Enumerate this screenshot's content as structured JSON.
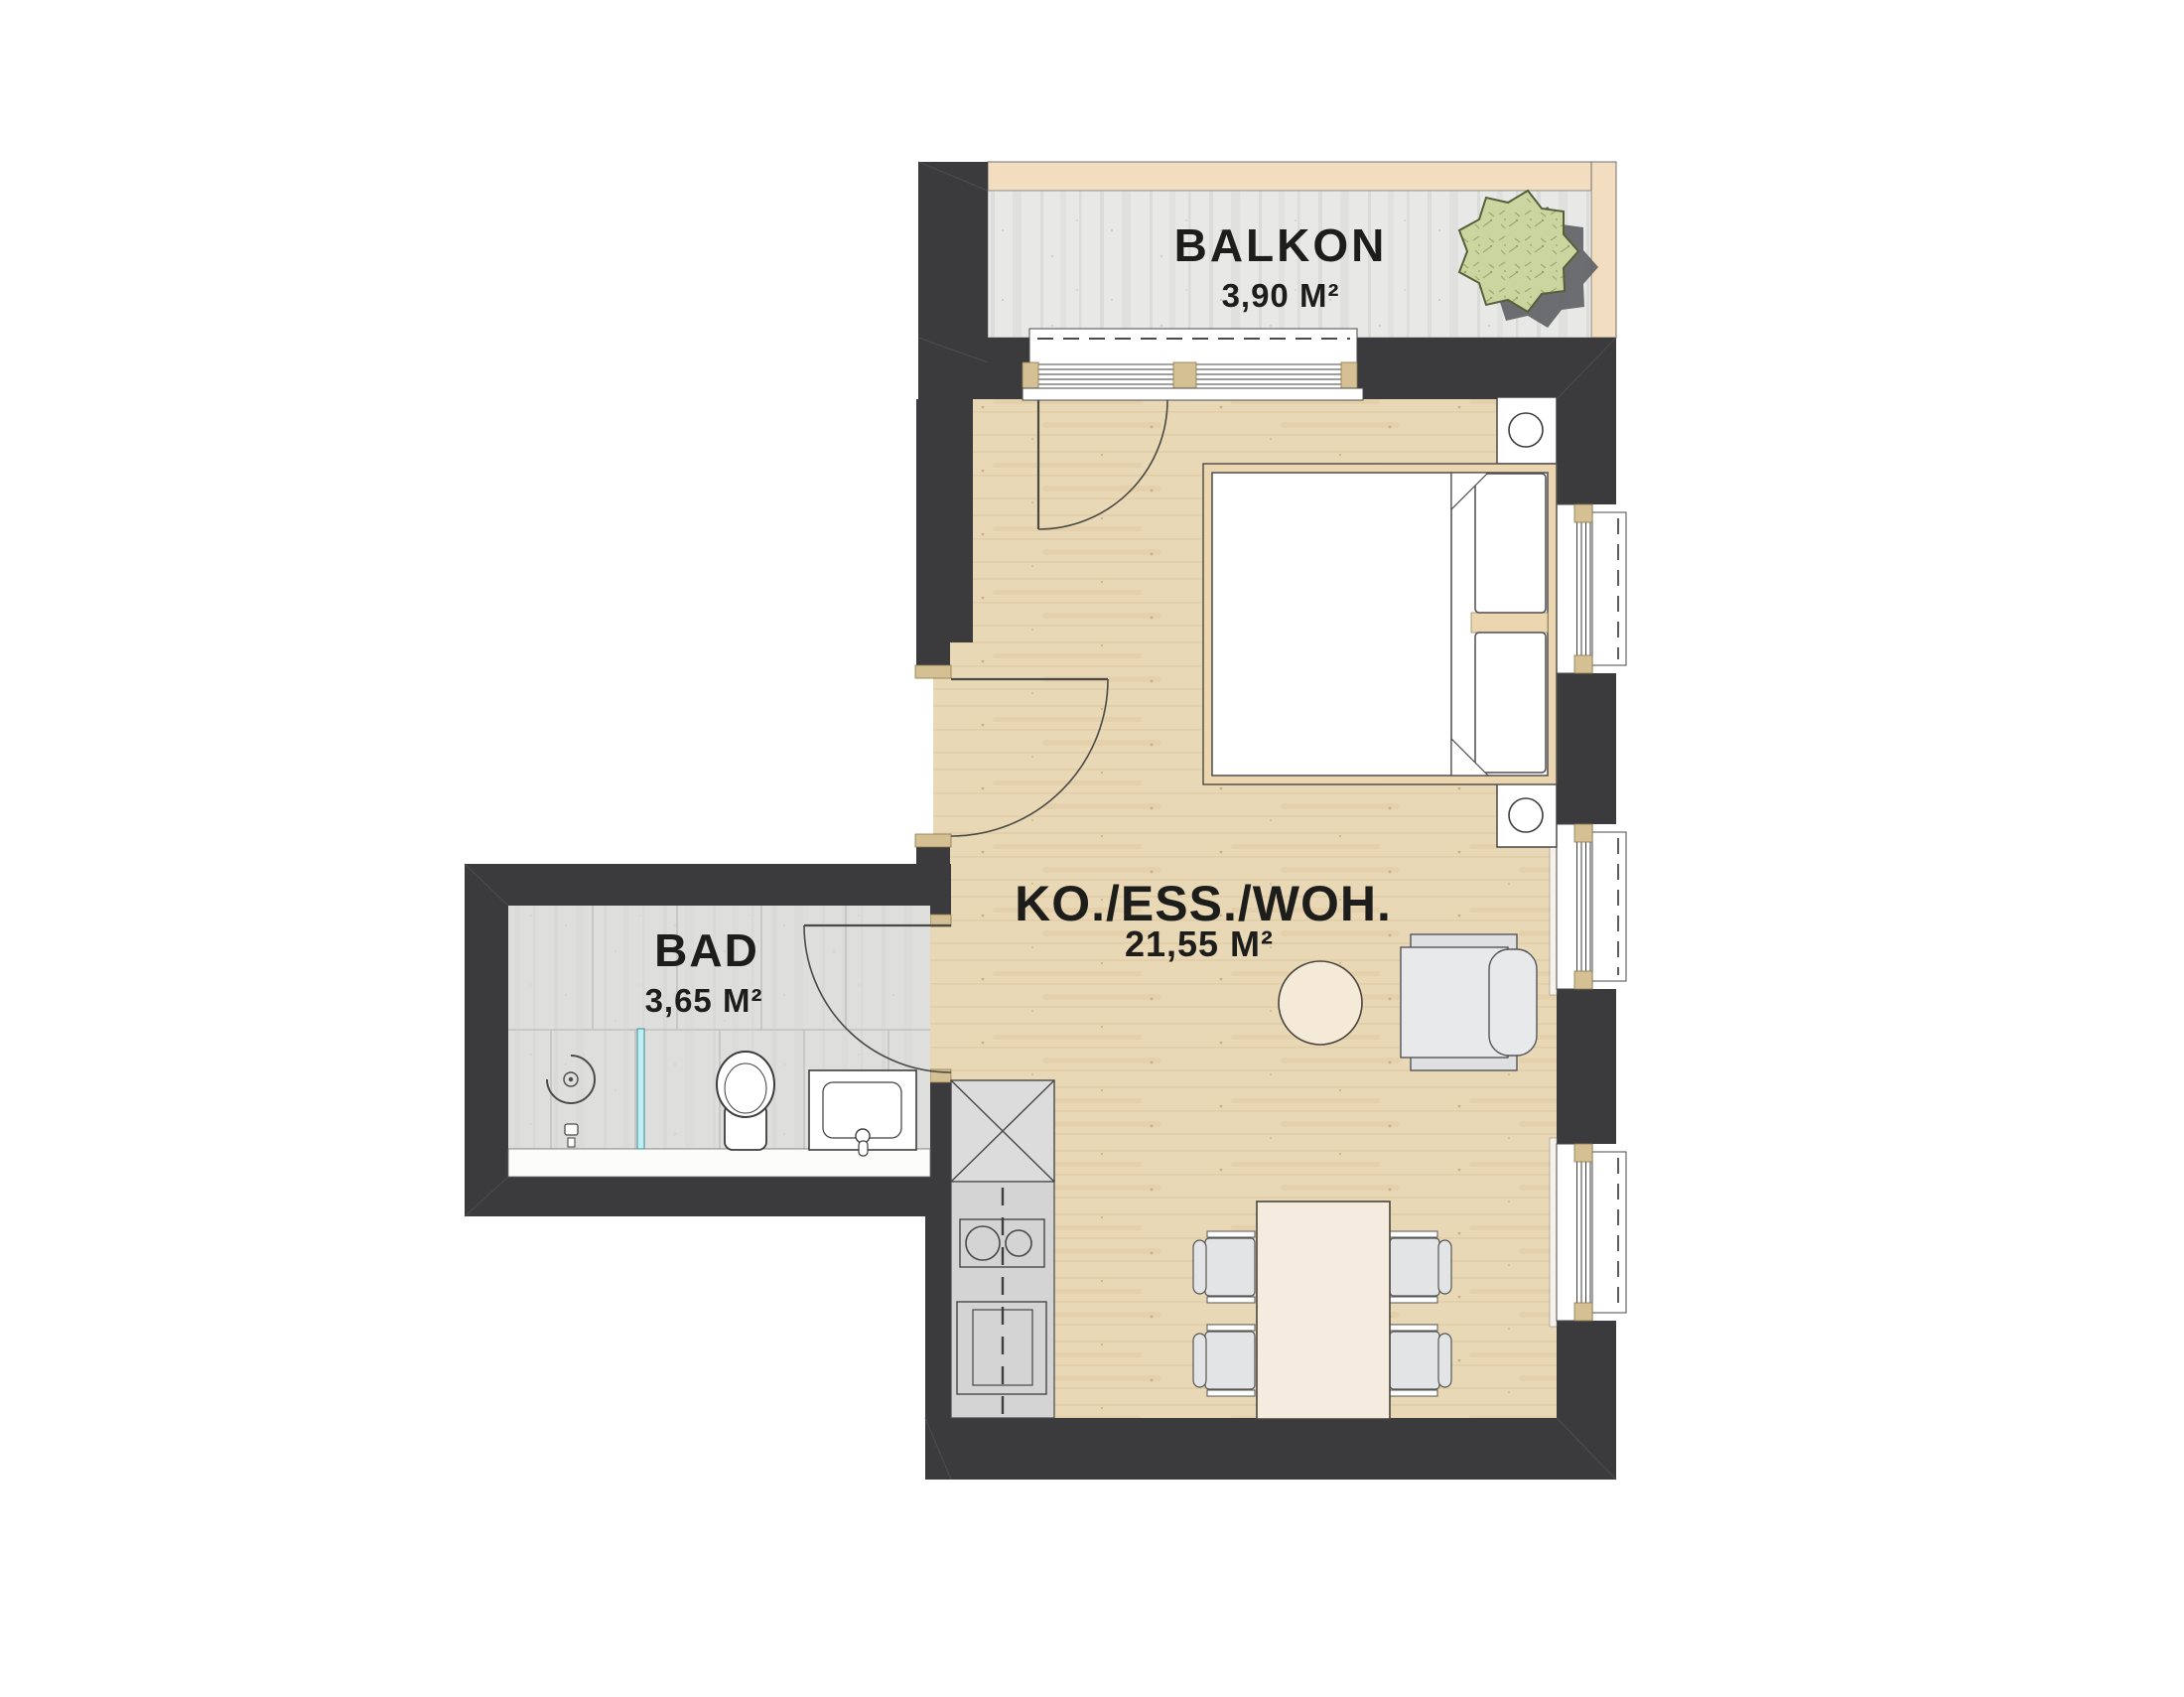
{
  "rooms": {
    "balcony": {
      "label": "BALKON",
      "area": "3,90 M²"
    },
    "living": {
      "label": "KO./ESS./WOH.",
      "area": "21,55 M²"
    },
    "bath": {
      "label": "BAD",
      "area": "3,65 M²"
    }
  },
  "colors": {
    "wall": "#3b3b3d",
    "wood_floor": "#e9d8b5",
    "balcony_concrete": "#e8e8e6",
    "bath_tile": "#d8d8d6",
    "frame_beige": "#d5c093",
    "bed_frame": "#ecd6b0",
    "railing": "#f3ddc0",
    "furniture_gray": "#e3e4e6",
    "table_cream": "#f5ecdf",
    "glass_partition": "#bfeef3",
    "plant_green": "#cbd5a0",
    "plant_shadow": "#5e5f63",
    "text": "#1d1d1b"
  },
  "symbols": [
    "potted-plant",
    "balcony-sliding-door",
    "entry-door",
    "bath-door",
    "double-bed",
    "pillow",
    "blanket-fold",
    "nightstand",
    "table-lamp",
    "window",
    "armchair",
    "side-table",
    "dining-table",
    "dining-chair",
    "kitchen-tall-cabinet",
    "kitchen-counter",
    "cooktop",
    "kitchen-sink",
    "toilet",
    "washbasin",
    "shower-drain",
    "shower-head",
    "glass-partition"
  ]
}
